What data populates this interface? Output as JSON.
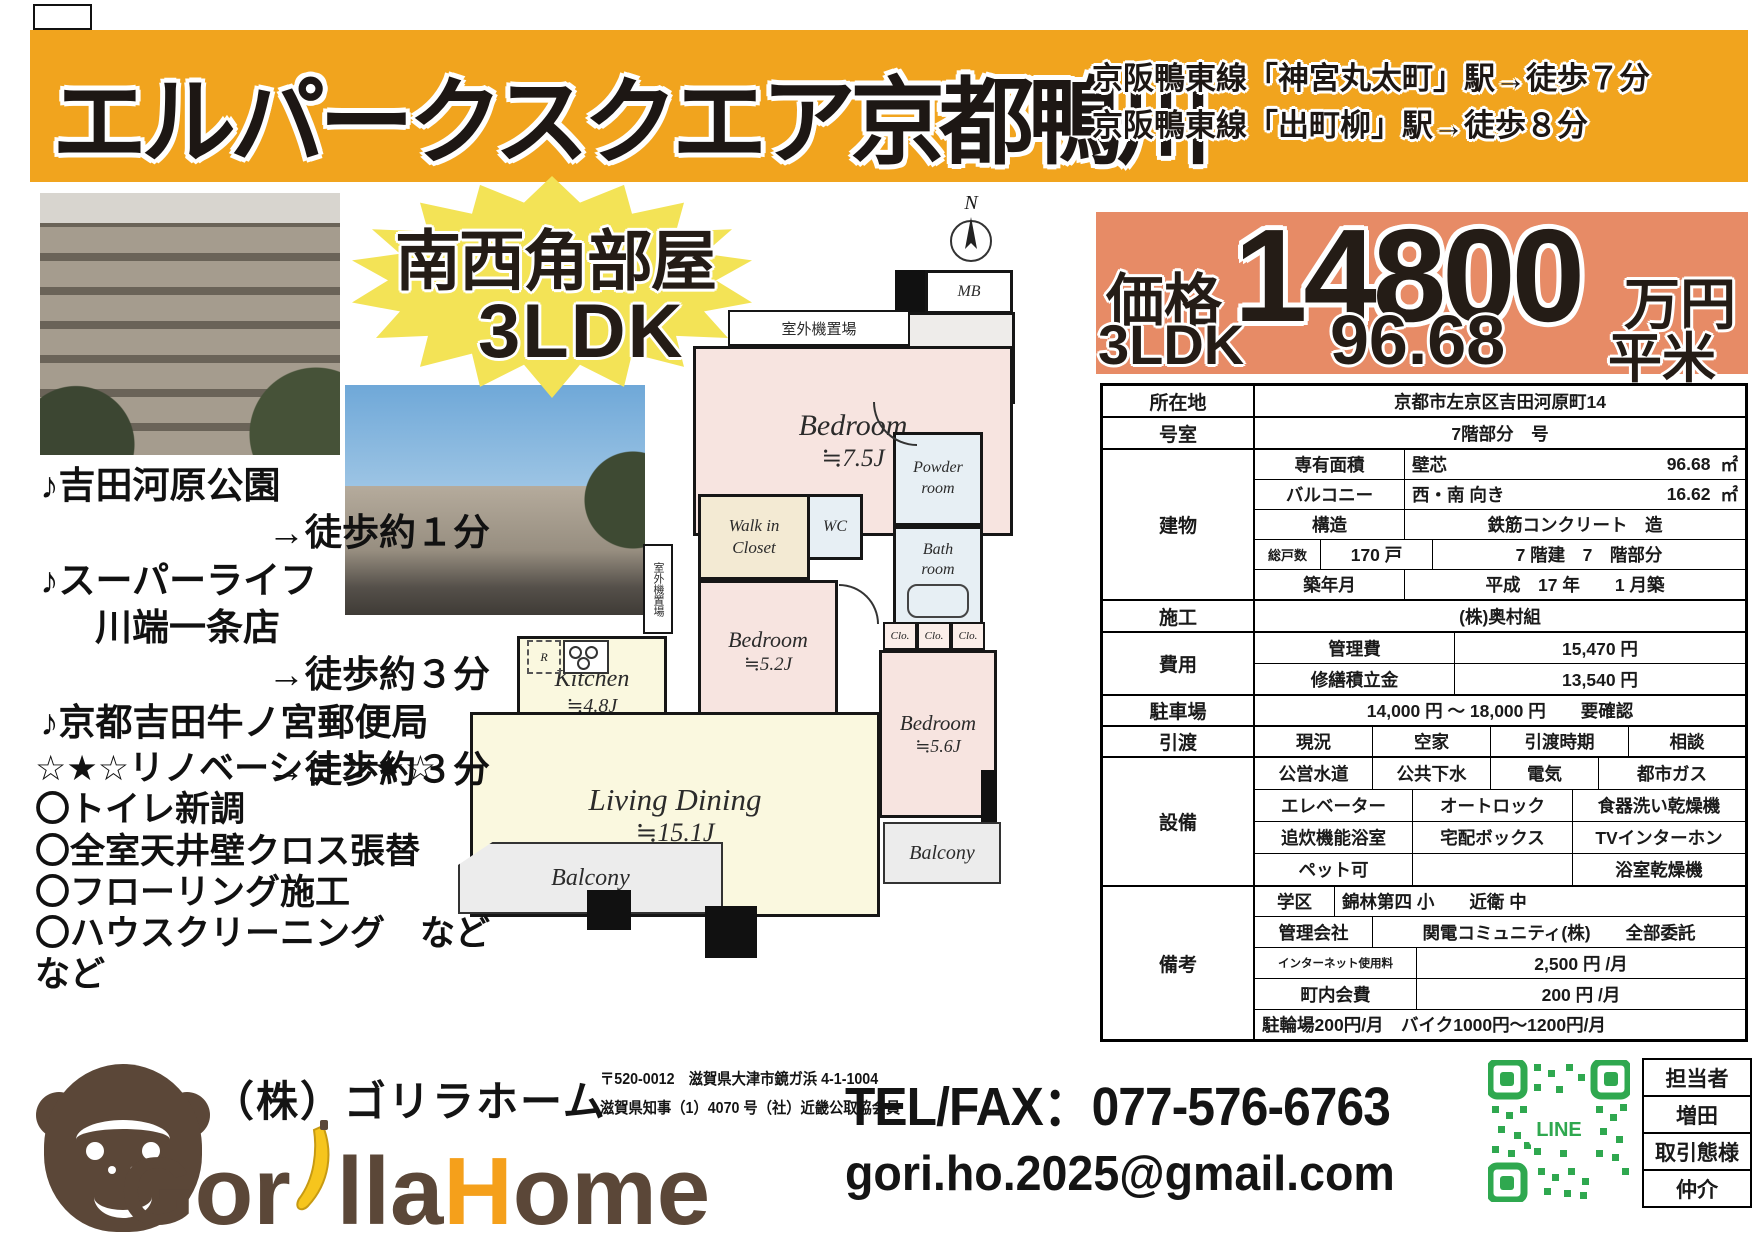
{
  "banner": {
    "title": "エルパークスクエア京都鴨川",
    "station1": "京阪鴨東線「神宮丸太町」駅→徒歩７分",
    "station2": "京阪鴨東線「出町柳」駅→徒歩８分"
  },
  "burst": {
    "line1": "南西角部屋",
    "line2": "3LDK"
  },
  "price": {
    "label": "価格",
    "value": "14800",
    "unit": "万円",
    "type": "3LDK",
    "area": "96.68",
    "area_unit": "平米"
  },
  "nearby": {
    "items": [
      {
        "line1": "♪吉田河原公園",
        "line2": "",
        "walk": "→徒歩約１分"
      },
      {
        "line1": "♪スーパーライフ",
        "line2": "川端一条店",
        "walk": "→徒歩約３分"
      },
      {
        "line1": "♪京都吉田牛ノ宮郵便局",
        "line2": "",
        "walk": "→徒歩約３分"
      }
    ]
  },
  "renovation": {
    "title": "☆★☆リノベーション★☆",
    "items": [
      "〇トイレ新調",
      "〇全室天井壁クロス張替",
      "〇フローリング施工",
      "〇ハウスクリーニング　などなど"
    ]
  },
  "floorplan": {
    "compass": "N",
    "mb": "MB",
    "ent": "Ent.",
    "sb": "SB",
    "outdoor": "室外機置場",
    "bedroom1": "Bedroom",
    "bedroom1_size": "≒7.5J",
    "powder1": "Powder",
    "powder2": "room",
    "wc": "WC",
    "bath1": "Bath",
    "bath2": "room",
    "wic1": "Walk in",
    "wic2": "Closet",
    "bedroom2": "Bedroom",
    "bedroom2_size": "≒5.2J",
    "bedroom3": "Bedroom",
    "bedroom3_size": "≒5.6J",
    "kitchen": "Kitchen",
    "kitchen_size": "≒4.8J",
    "living": "Living Dining",
    "living_size": "≒15.1J",
    "balcony": "Balcony",
    "clo": "Clo.",
    "r": "R"
  },
  "spec_table": {
    "location_label": "所在地",
    "location": "京都市左京区吉田河原町14",
    "room_label": "号室",
    "room": "7階部分　号",
    "building_label": "建物",
    "senyu_label": "専有面積",
    "senyu_kind": "壁芯",
    "senyu_val": "96.68",
    "senyu_unit": "㎡",
    "balc_label": "バルコニー",
    "balc_kind": "西・南 向き",
    "balc_val": "16.62",
    "balc_unit": "㎡",
    "kozo_label": "構造",
    "kozo": "鉄筋コンクリート　造",
    "units_label": "総戸数",
    "units": "170 戸",
    "floors": "7 階建　7　階部分",
    "built_label": "築年月",
    "built": "平成　17 年　　1 月築",
    "seko_label": "施工",
    "seko": "(株)奥村組",
    "cost_label": "費用",
    "kanri_label": "管理費",
    "kanri": "15,470 円",
    "shuzen_label": "修繕積立金",
    "shuzen": "13,540 円",
    "parking_label": "駐車場",
    "parking": "14,000 円 ～ 18,000 円　　要確認",
    "handover_label": "引渡",
    "handover_cells": [
      "現況",
      "空家",
      "引渡時期",
      "相談"
    ],
    "equip_label": "設備",
    "equip_rows": [
      [
        "公営水道",
        "公共下水",
        "電気",
        "都市ガス"
      ],
      [
        "エレベーター",
        "オートロック",
        "食器洗い乾燥機"
      ],
      [
        "追炊機能浴室",
        "宅配ボックス",
        "TVインターホン"
      ],
      [
        "ペット可",
        "",
        "浴室乾燥機"
      ]
    ],
    "notes_label": "備考",
    "school_label": "学区",
    "school": "錦林第四 小　　近衛 中",
    "mgmtco_label": "管理会社",
    "mgmtco": "関電コミュニティ(株)　　全部委託",
    "internet_label": "インターネット使用料",
    "internet": "2,500 円 /月",
    "chonai_label": "町内会費",
    "chonai": "200 円 /月",
    "bike": "駐輪場200円/月　バイク1000円～1200円/月"
  },
  "footer": {
    "company": "（株）ゴリラホーム",
    "logo": {
      "part1": "Gor",
      "part2": "lla",
      "part3": "H",
      "part4": "ome"
    },
    "postal": "〒520-0012　滋賀県大津市鏡ガ浜 4-1-1004",
    "license": "滋賀県知事（1）4070 号（社）近畿公取協会員",
    "tel": "TEL/FAX：077-576-6763",
    "email": "gori.ho.2025@gmail.com",
    "line_label": "LINE",
    "agent": {
      "label": "担当者",
      "name": "増田",
      "type_label": "取引態様",
      "type": "仲介"
    }
  },
  "colors": {
    "banner_yellow": "#F1A41E",
    "burst_yellow": "#F3E356",
    "price_salmon": "#E78B66",
    "qr_green": "#2FA84F",
    "gorilla_brown": "#5B4738",
    "banana_yellow": "#F6C51D",
    "logo_orange": "#F5A01B"
  }
}
